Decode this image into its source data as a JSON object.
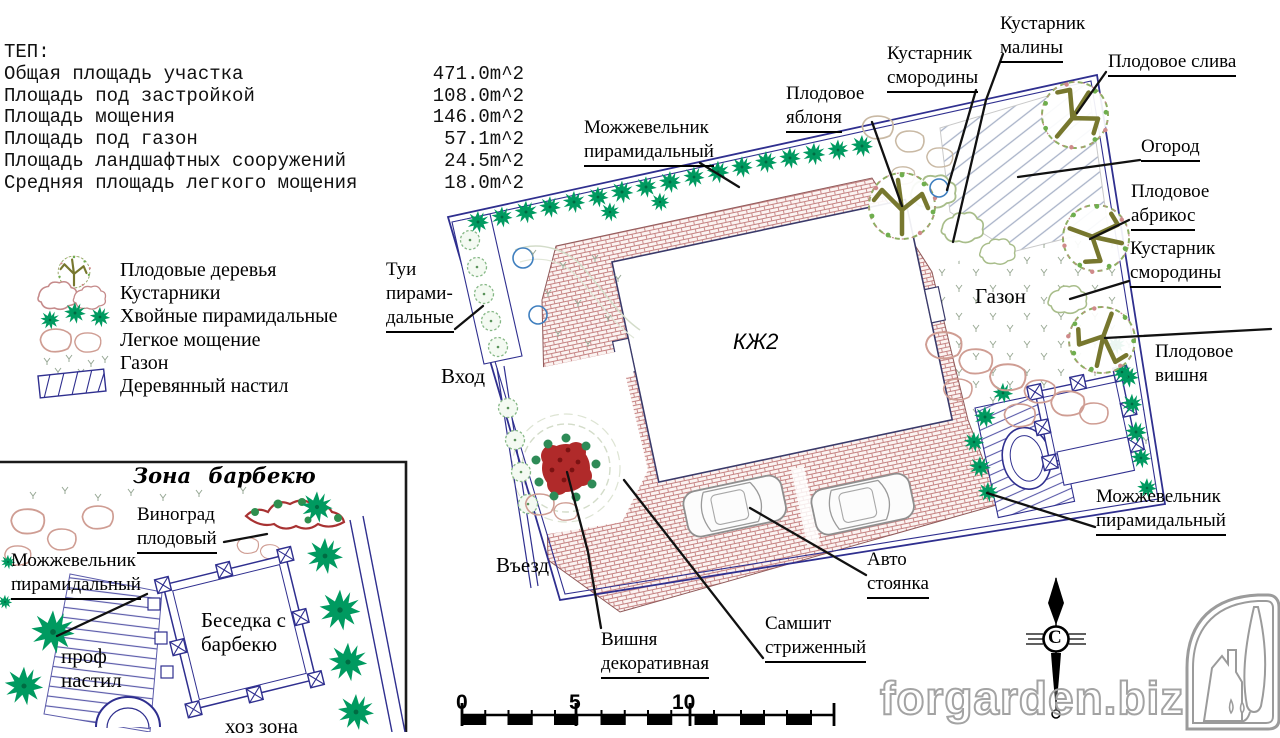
{
  "tep": {
    "title": "ТЕП:",
    "rows": [
      {
        "label": "Общая площадь участка",
        "value": "471.0m^2"
      },
      {
        "label": "Площадь под застройкой",
        "value": "108.0m^2"
      },
      {
        "label": "Площадь мощения",
        "value": "146.0m^2"
      },
      {
        "label": "Площадь под газон",
        "value": "57.1m^2"
      },
      {
        "label": "Площадь ландшафтных сооружений",
        "value": "24.5m^2"
      },
      {
        "label": "Средняя площадь легкого мощения",
        "value": "18.0m^2"
      }
    ]
  },
  "legend": {
    "items": [
      {
        "icon": "fruit-tree-symbol",
        "label": "Плодовые деревья"
      },
      {
        "icon": "shrub-symbol",
        "label": "Кустарники"
      },
      {
        "icon": "conifer-symbol",
        "label": "Хвойные пирамидальные"
      },
      {
        "icon": "light-paving-symbol",
        "label": "Легкое мощение"
      },
      {
        "icon": "lawn-symbol",
        "label": "Газон"
      },
      {
        "icon": "deck-symbol",
        "label": "Деревянный настил"
      }
    ]
  },
  "plan": {
    "building": "КЖ2",
    "labels": {
      "raspberry": {
        "lines": [
          "Кустарник",
          "малины"
        ]
      },
      "currant_top": {
        "lines": [
          "Кустарник",
          "смородины"
        ]
      },
      "plum": {
        "lines": [
          "Плодовое слива"
        ]
      },
      "apple": {
        "lines": [
          "Плодовое",
          "яблоня"
        ]
      },
      "juniper_top": {
        "lines": [
          "Можжевельник",
          "пирамидальный"
        ]
      },
      "ogorod": {
        "lines": [
          "Огород"
        ]
      },
      "apricot": {
        "lines": [
          "Плодовое",
          "абрикос"
        ]
      },
      "currant_right": {
        "lines": [
          "Кустарник",
          "смородины"
        ]
      },
      "lawn": {
        "lines": [
          "Газон"
        ]
      },
      "cherry_fruit": {
        "lines": [
          "Плодовое",
          "вишня"
        ]
      },
      "tui": {
        "lines": [
          "Туи",
          "пирами-",
          "дальные"
        ]
      },
      "entrance": {
        "lines": [
          "Вход"
        ]
      },
      "drive": {
        "lines": [
          "Въезд"
        ]
      },
      "cherry_dec": {
        "lines": [
          "Вишня",
          "декоративная"
        ]
      },
      "boxwood": {
        "lines": [
          "Самшит",
          "стриженный"
        ]
      },
      "parking": {
        "lines": [
          "Авто",
          "стоянка"
        ]
      },
      "juniper_bottom": {
        "lines": [
          "Можжевельник",
          "пирамидальный"
        ]
      }
    }
  },
  "inset": {
    "title": "Зона барбекю",
    "labels": {
      "grape": {
        "lines": [
          "Виноград",
          "плодовый"
        ]
      },
      "juniper": {
        "lines": [
          "Можжевельник",
          "пирамидальный"
        ]
      },
      "gazebo": {
        "lines": [
          "Беседка с",
          "барбекю"
        ]
      },
      "deck": {
        "lines": [
          "проф",
          "настил"
        ]
      },
      "utility": {
        "lines": [
          "хоз зона"
        ]
      }
    }
  },
  "scalebar": {
    "ticks": [
      "0",
      "5",
      "10"
    ]
  },
  "compass": {
    "letter": "С"
  },
  "watermark": "forgarden.biz",
  "colors": {
    "boundary_navy": "#2f2f8f",
    "brick_paving": "#c58282",
    "conifer_green": "#009a60",
    "fruit_branch_olive": "#77772e",
    "decorative_cherry_red": "#b02a2a",
    "garden_hatch": "#a8b2c8",
    "stone_pink": "#cf9d93"
  }
}
